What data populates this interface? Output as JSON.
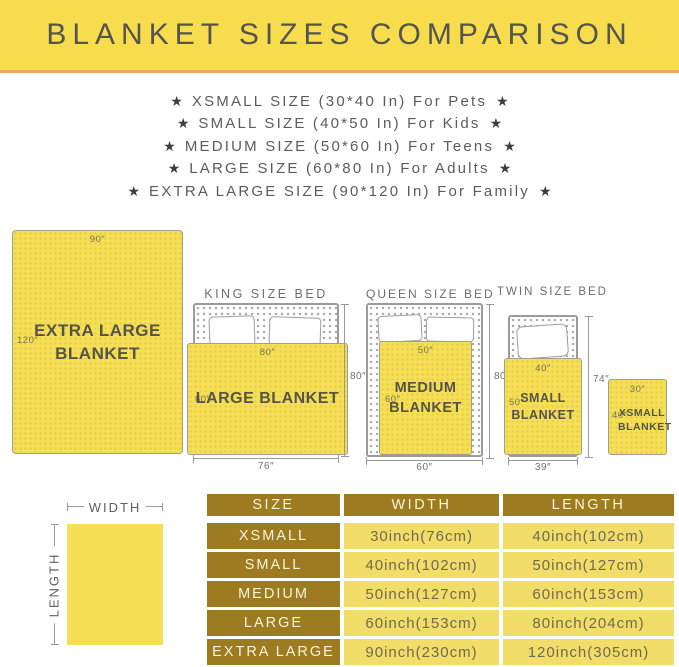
{
  "banner": {
    "title": "BLANKET SIZES COMPARISON"
  },
  "star": "★",
  "size_list": [
    "XSMALL SIZE (30*40 In) For Pets",
    "SMALL SIZE (40*50 In) For Kids",
    "MEDIUM SIZE (50*60 In) For Teens",
    "LARGE SIZE (60*80 In) For Adults",
    "EXTRA LARGE SIZE (90*120 In) For Family"
  ],
  "diagram": {
    "extra_large": {
      "width_label": "90″",
      "length_label": "120″",
      "name_line1": "EXTRA LARGE",
      "name_line2": "BLANKET"
    },
    "king": {
      "title": "KING SIZE BED",
      "blanket_width": "80″",
      "blanket_length": "60″",
      "blanket_name": "LARGE BLANKET",
      "bed_width": "76″",
      "bed_height": "80″"
    },
    "queen": {
      "title": "QUEEN SIZE BED",
      "blanket_width": "50″",
      "blanket_length": "60″",
      "name_line1": "MEDIUM",
      "name_line2": "BLANKET",
      "bed_width": "60″",
      "bed_height": "80″"
    },
    "twin": {
      "title": "TWIN SIZE BED",
      "blanket_width": "40″",
      "blanket_length": "50″",
      "name_line1": "SMALL",
      "name_line2": "BLANKET",
      "bed_width": "39″",
      "bed_height": "74″"
    },
    "xsmall": {
      "width_label": "30″",
      "length_label": "40″",
      "name_line1": "XSMALL",
      "name_line2": "BLANKET"
    }
  },
  "legend": {
    "width_label": "WIDTH",
    "length_label": "LENGTH"
  },
  "table": {
    "headers": [
      "SIZE",
      "WIDTH",
      "LENGTH"
    ],
    "rows": [
      {
        "size": "XSMALL",
        "width": "30inch(76cm)",
        "length": "40inch(102cm)"
      },
      {
        "size": "SMALL",
        "width": "40inch(102cm)",
        "length": "50inch(127cm)"
      },
      {
        "size": "MEDIUM",
        "width": "50inch(127cm)",
        "length": "60inch(153cm)"
      },
      {
        "size": "LARGE",
        "width": "60inch(153cm)",
        "length": "80inch(204cm)"
      },
      {
        "size": "EXTRA LARGE",
        "width": "90inch(230cm)",
        "length": "120inch(305cm)"
      }
    ]
  },
  "colors": {
    "banner_bg": "#F7DD4E",
    "banner_underline": "#EDAA5D",
    "title_text": "#55554D",
    "blanket_yellow": "#F5DF55",
    "table_gold": "#9D7B20",
    "table_cell_bg": "#F2DD68",
    "table_cell_text": "#6E6B52"
  }
}
